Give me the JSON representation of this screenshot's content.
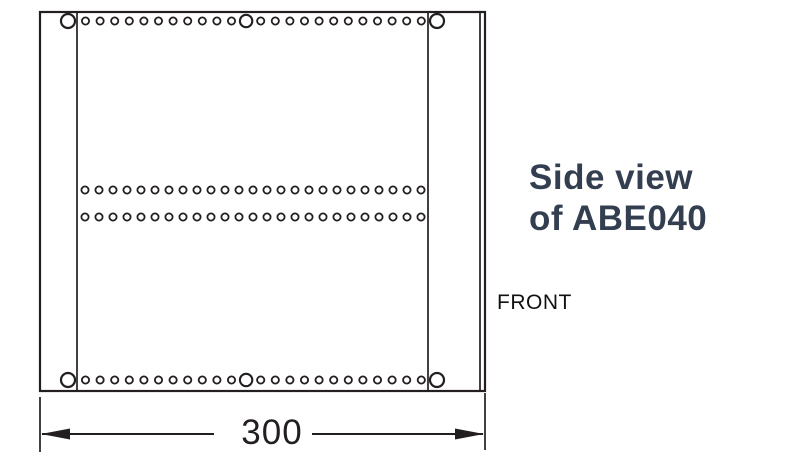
{
  "title": {
    "line1": "Side view",
    "line2": "of ABE040",
    "color": "#333F50"
  },
  "front_label": "FRONT",
  "dimension": {
    "label": "300"
  },
  "colors": {
    "line": "#231F20",
    "background": "#FFFFFF",
    "title_text": "#333F50",
    "body_text": "#111111"
  },
  "diagram": {
    "outer_rect": {
      "x": 40,
      "y": 12,
      "width": 445,
      "height": 379
    },
    "inner_vertical_lines_x": [
      77,
      428,
      480
    ],
    "corner_holes": {
      "radius": 7,
      "stroke_width": 2.2,
      "centers": [
        [
          68,
          21
        ],
        [
          437,
          21
        ],
        [
          68,
          380
        ],
        [
          437,
          380
        ]
      ]
    },
    "hole_rows": [
      {
        "name": "top-hole-row",
        "y": 21,
        "start_x": 85.5,
        "spacing": 14.6,
        "count": 24,
        "small_radius": 3.6,
        "large_indices": [
          11
        ],
        "large_radius": 6.2
      },
      {
        "name": "middle-hole-row-1",
        "y": 190,
        "start_x": 85,
        "spacing": 14.0,
        "count": 25,
        "small_radius": 3.6,
        "large_indices": [],
        "large_radius": 6.2
      },
      {
        "name": "middle-hole-row-2",
        "y": 217,
        "start_x": 85,
        "spacing": 14.0,
        "count": 25,
        "small_radius": 3.6,
        "large_indices": [],
        "large_radius": 6.2
      },
      {
        "name": "bottom-hole-row",
        "y": 380,
        "start_x": 85.5,
        "spacing": 14.6,
        "count": 24,
        "small_radius": 3.6,
        "large_indices": [
          11
        ],
        "large_radius": 6.2
      }
    ],
    "dimension_geometry": {
      "extension_lines": [
        {
          "x": 40,
          "y1": 397,
          "y2": 452
        },
        {
          "x": 485,
          "y1": 393,
          "y2": 450
        }
      ],
      "line_y": 434,
      "line_segments": [
        [
          42,
          214
        ],
        [
          312,
          483
        ]
      ],
      "arrow_length": 29,
      "arrow_half_height": 5.5
    }
  }
}
